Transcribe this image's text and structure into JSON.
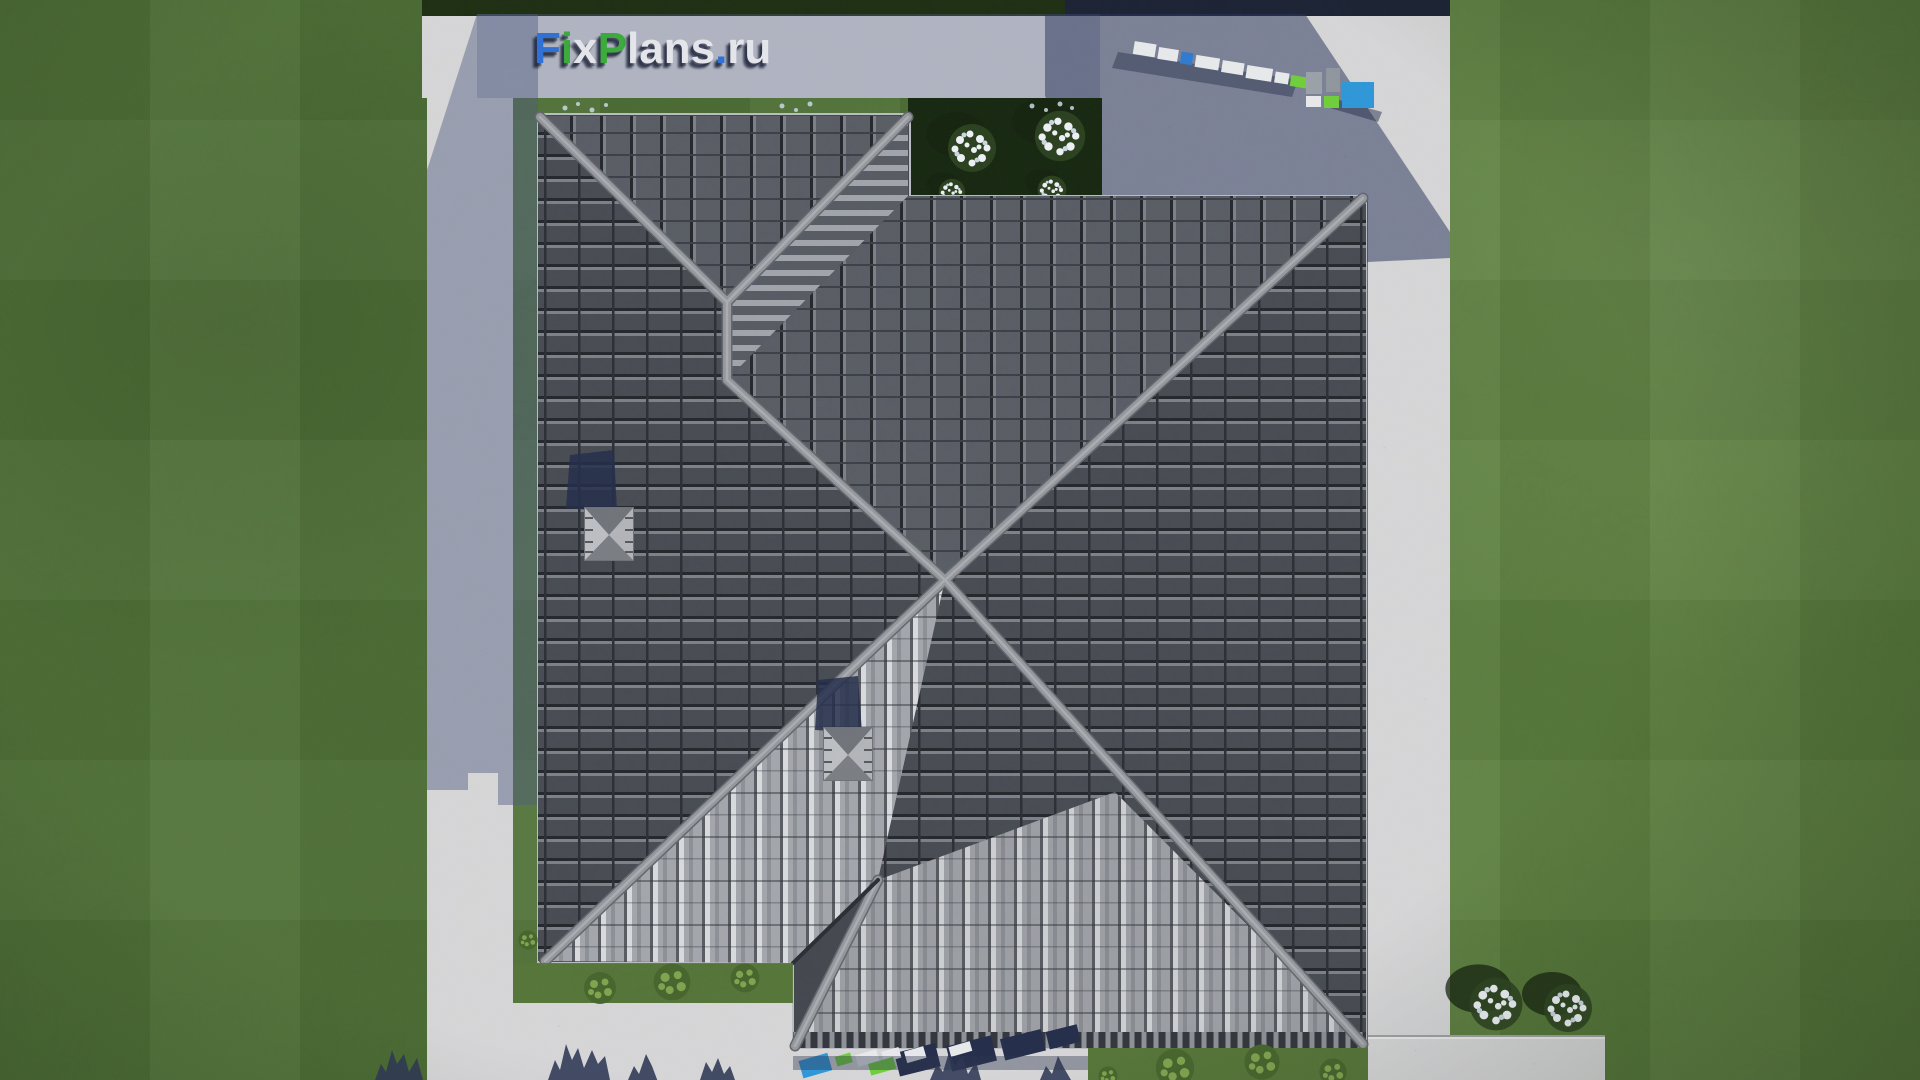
{
  "meta": {
    "description": "Aerial top-down 3D render of a house with a dark tiled hip roof, surrounded by a light concrete path and green lawn",
    "source_watermark": "FixPlans.ru"
  },
  "watermark": {
    "text": "FixPlans.ru",
    "letters": [
      {
        "ch": "F",
        "color": "#2e6fd6"
      },
      {
        "ch": "i",
        "color": "#3aa93a"
      },
      {
        "ch": "x",
        "color": "#e5e6ec"
      },
      {
        "ch": "P",
        "color": "#3aa93a"
      },
      {
        "ch": "l",
        "color": "#e5e6ec"
      },
      {
        "ch": "a",
        "color": "#e5e6ec"
      },
      {
        "ch": "n",
        "color": "#e5e6ec"
      },
      {
        "ch": "s",
        "color": "#e5e6ec"
      },
      {
        "ch": ".",
        "color": "#2e6fd6"
      },
      {
        "ch": "r",
        "color": "#e5e6ec"
      },
      {
        "ch": "u",
        "color": "#e5e6ec"
      }
    ],
    "shadow_color": "#1c2440"
  },
  "palette": {
    "grass_base": "#4f7136",
    "grass_light": "#5a7d3c",
    "concrete": "#d6d6d8",
    "concrete_shadow": "#8a92ac",
    "roof_dark": "#474a52",
    "roof_medium": "#585b64",
    "roof_bright": "#a3a5ac",
    "ridge_cap": "#94979d",
    "hedge": "#1d2d12",
    "garden_bed": "#162610",
    "shadow_navy": "#232c4a",
    "flower_white": "#edf1f5",
    "accent_blue": "#2e79d0",
    "accent_green": "#6fce3a"
  },
  "scene": {
    "objects": [
      "lawn with mowing stripes",
      "concrete path ring around house",
      "hip roof with gray tiles, ridges and valleys",
      "two pyramid roof hatches with shadows",
      "dark garden bed with white flower bushes (top notch)",
      "white flower bushes on lawn (bottom right)",
      "green shrubs along bottom eaves",
      "3D FixPlans letters standing on path (top right and bottom)",
      "tree shadows at bottom edge",
      "building shadow on left path"
    ]
  }
}
